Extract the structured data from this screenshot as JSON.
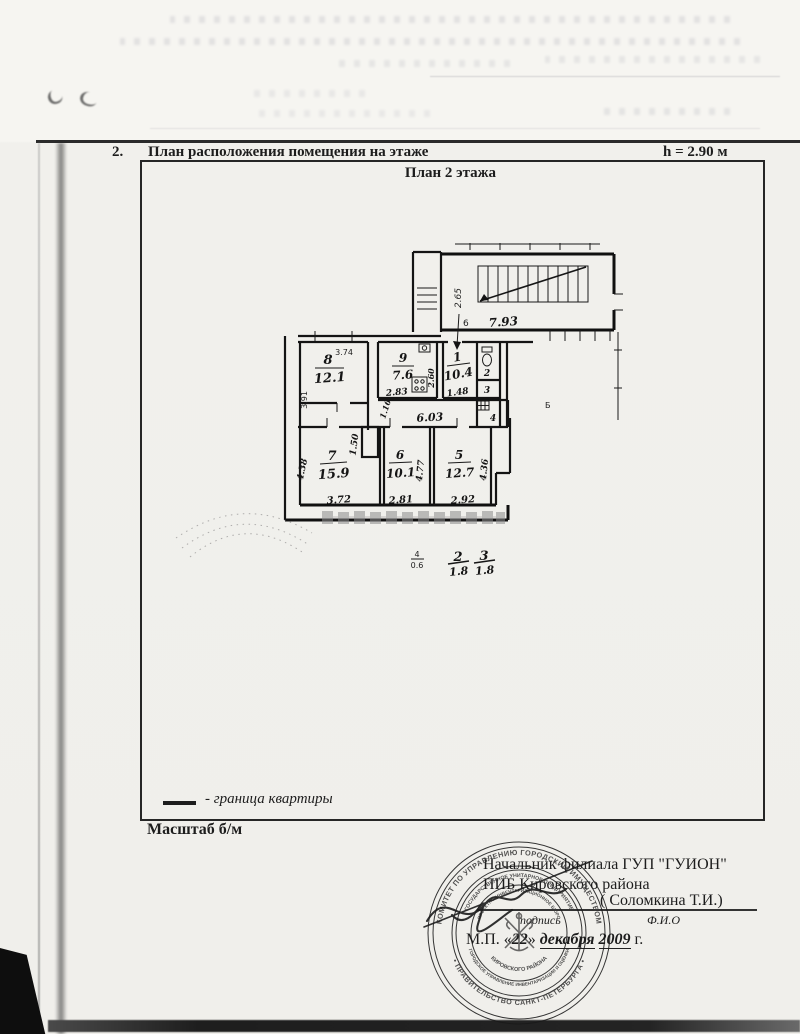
{
  "header": {
    "number": "2.",
    "title": "План расположения помещения на этаже",
    "height_note": "h = 2.90 м"
  },
  "plan": {
    "title": "План 2 этажа",
    "stair": {
      "dim_height": "2.65",
      "dim_width": "7.93",
      "entry_mark": "6"
    },
    "rooms": {
      "r1": {
        "num": "1",
        "area": "10.4"
      },
      "r2": {
        "num": "2"
      },
      "r3": {
        "num": "3"
      },
      "r4": {
        "num": "4"
      },
      "r5": {
        "num": "5",
        "area": "12.7"
      },
      "r6": {
        "num": "6",
        "area": "10.1"
      },
      "r7": {
        "num": "7",
        "area": "15.9"
      },
      "r8": {
        "num": "8",
        "area": "12.1"
      },
      "r9": {
        "num": "9",
        "area": "7.6"
      },
      "side_mark": "Б"
    },
    "dims": {
      "d374": "3.74",
      "d391": "3.91",
      "d283": "2.83",
      "d260": "2.60",
      "d148": "1.48",
      "d603": "6.03",
      "d116": "1.16",
      "d150": "1.50",
      "d438": "4.38",
      "d372": "3.72",
      "d477": "4.77",
      "d281": "2.81",
      "d436": "4.36",
      "d292": "2.92"
    },
    "fractions": [
      {
        "num": "4",
        "den": "0.6"
      },
      {
        "num": "2",
        "den": "1.8"
      },
      {
        "num": "3",
        "den": "1.8"
      }
    ]
  },
  "legend": {
    "boundary_label": "- граница квартиры",
    "scale_label": "Масштаб  б/м"
  },
  "footer": {
    "approver_line1": "Начальник филиала ГУП \"ГУИОН\"",
    "approver_line2": "ПИБ Кировского района",
    "name": "( Соломкина Т.И.)",
    "fio_label": "Ф.И.О",
    "signature_label": "подпись",
    "date_prefix": "М.П.  «",
    "date_day": "22",
    "date_mid": "» ",
    "date_month": "декабря",
    "date_year": "2009",
    "date_suffix": " г."
  },
  "stamp": {
    "outer_top": "КОМИТЕТ ПО УПРАВЛЕНИЮ ГОРОДСКИМ ИМУЩЕСТВОМ",
    "outer_bottom": "• ПРАВИТЕЛЬСТВО САНКТ-ПЕТЕРБУРГА •",
    "middle_top": "ГОСУДАРСТВЕННОЕ УНИТАРНОЕ ПРЕДПРИЯТИЕ",
    "middle_bottom": "ГОРОДСКОЕ УПРАВЛЕНИЕ ИНВЕНТАРИЗАЦИИ И ОЦЕНКИ",
    "inner_top": "ПРОЕКТНО-ИНВЕНТАРИЗАЦИОННОЕ БЮРО",
    "inner_bottom": "КИРОВСКОГО РАЙОНА"
  }
}
